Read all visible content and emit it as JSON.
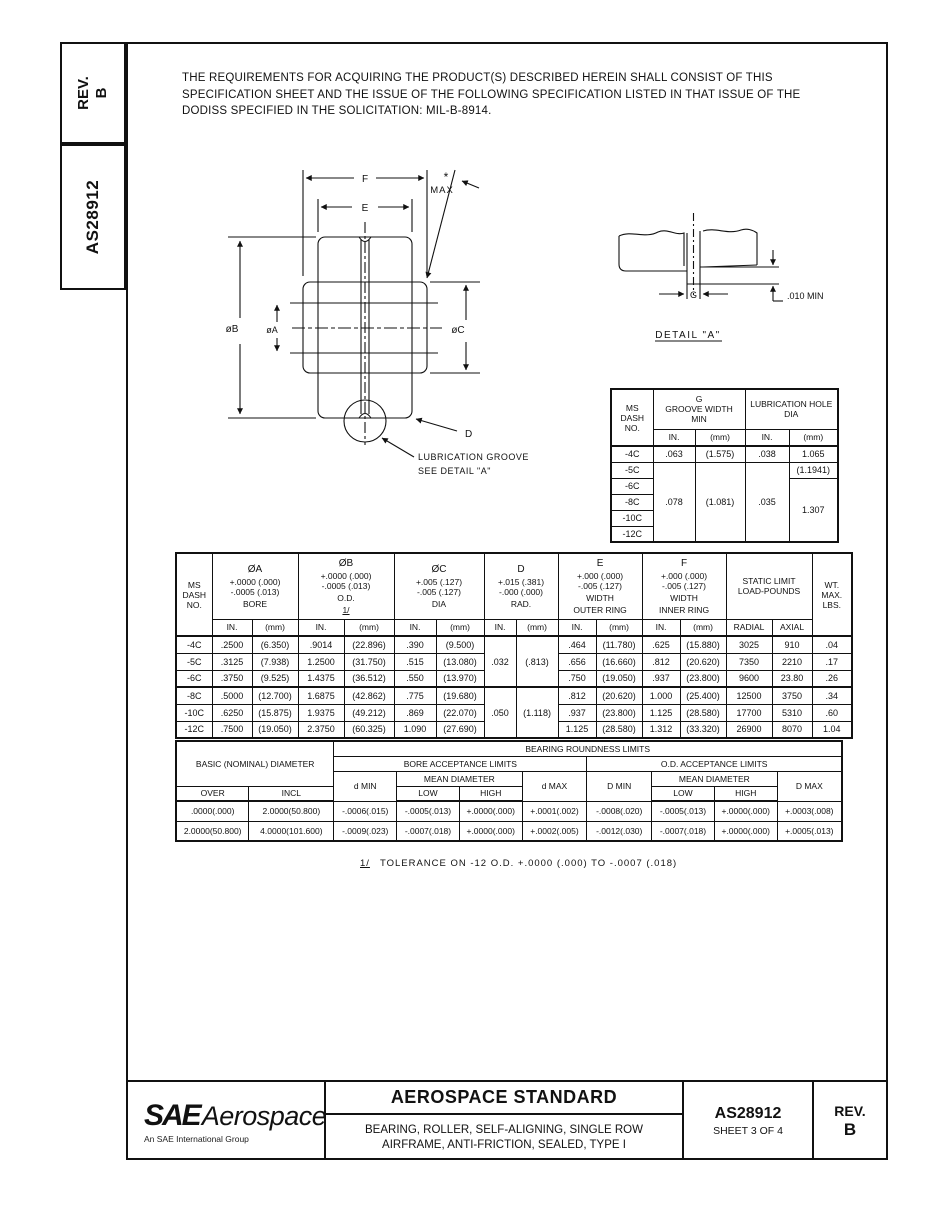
{
  "sidebar": {
    "rev": "REV.\nB",
    "doc_number": "AS28912"
  },
  "intro": {
    "text": "THE REQUIREMENTS FOR ACQUIRING THE PRODUCT(S) DESCRIBED HEREIN SHALL CONSIST OF THIS\nSPECIFICATION SHEET AND THE ISSUE OF THE FOLLOWING SPECIFICATION LISTED IN THAT ISSUE OF THE\nDODISS SPECIFIED IN THE SOLICITATION:  MIL-B-8914."
  },
  "drawing": {
    "f": "F",
    "e": "E",
    "asterisk": "*",
    "max": "MAX",
    "dia_b": "øB",
    "dia_a": "øA",
    "dia_c": "øC",
    "d": "D",
    "lube_line1": "LUBRICATION  GROOVE",
    "lube_line2": "SEE  DETAIL  \"A\"",
    "detail_g": "G",
    "detail_min": ".010 MIN",
    "detail_title": "DETAIL \"A\""
  },
  "groove_table": {
    "h_dash": "MS\nDASH\nNO.",
    "h_g": "G\nGROOVE WIDTH\nMIN",
    "h_hole": "LUBRICATION HOLE\nDIA",
    "h_in": "IN.",
    "h_mm": "(mm)",
    "dash": [
      "-4C",
      "-5C",
      "-6C",
      "-8C",
      "-10C",
      "-12C"
    ],
    "r4c": {
      "g_in": ".063",
      "g_mm": "(1.575)",
      "hole_in": ".038",
      "hole_mm": "1.065"
    },
    "r5c": {
      "hole_mm": "(1.1941)"
    },
    "merged": {
      "g_in": ".078",
      "g_mm": "(1.081)",
      "hole_in": ".035",
      "hole_mm": "1.307"
    }
  },
  "dim_table": {
    "h_dash": "MS\nDASH\nNO.",
    "h_in": "IN.",
    "h_mm": "(mm)",
    "cols": {
      "a": {
        "sym": "ØA",
        "tol1": "+.0000 (.000)",
        "tol2": "-.0005 (.013)",
        "name": "BORE"
      },
      "b": {
        "sym": "ØB",
        "tol1": "+.0000 (.000)",
        "tol2": "-.0005 (.013)",
        "name": "O.D.",
        "note": "1/"
      },
      "c": {
        "sym": "ØC",
        "tol1": "+.005 (.127)",
        "tol2": "-.005 (.127)",
        "name": "DIA"
      },
      "d": {
        "sym": "D",
        "tol1": "+.015 (.381)",
        "tol2": "-.000 (.000)",
        "name": "RAD."
      },
      "e": {
        "sym": "E",
        "tol1": "+.000 (.000)",
        "tol2": "-.005 (.127)",
        "name": "WIDTH",
        "name2": "OUTER RING"
      },
      "f": {
        "sym": "F",
        "tol1": "+.000 (.000)",
        "tol2": "-.005 (.127)",
        "name": "WIDTH",
        "name2": "INNER RING"
      },
      "static": {
        "label": "STATIC LIMIT\nLOAD-POUNDS",
        "radial": "RADIAL",
        "axial": "AXIAL"
      },
      "wt": {
        "label": "WT.\nMAX.\nLBS."
      }
    },
    "d_groups": [
      {
        "in": ".032",
        "mm": "(.813)"
      },
      {
        "in": ".050",
        "mm": "(1.118)"
      }
    ],
    "rows": [
      {
        "dash": "-4C",
        "a_in": ".2500",
        "a_mm": "(6.350)",
        "b_in": ".9014",
        "b_mm": "(22.896)",
        "c_in": ".390",
        "c_mm": "(9.500)",
        "e_in": ".464",
        "e_mm": "(11.780)",
        "f_in": ".625",
        "f_mm": "(15.880)",
        "radial": "3025",
        "axial": "910",
        "wt": ".04"
      },
      {
        "dash": "-5C",
        "a_in": ".3125",
        "a_mm": "(7.938)",
        "b_in": "1.2500",
        "b_mm": "(31.750)",
        "c_in": ".515",
        "c_mm": "(13.080)",
        "e_in": ".656",
        "e_mm": "(16.660)",
        "f_in": ".812",
        "f_mm": "(20.620)",
        "radial": "7350",
        "axial": "2210",
        "wt": ".17"
      },
      {
        "dash": "-6C",
        "a_in": ".3750",
        "a_mm": "(9.525)",
        "b_in": "1.4375",
        "b_mm": "(36.512)",
        "c_in": ".550",
        "c_mm": "(13.970)",
        "e_in": ".750",
        "e_mm": "(19.050)",
        "f_in": ".937",
        "f_mm": "(23.800)",
        "radial": "9600",
        "axial": "23.80",
        "wt": ".26"
      },
      {
        "dash": "-8C",
        "a_in": ".5000",
        "a_mm": "(12.700)",
        "b_in": "1.6875",
        "b_mm": "(42.862)",
        "c_in": ".775",
        "c_mm": "(19.680)",
        "e_in": ".812",
        "e_mm": "(20.620)",
        "f_in": "1.000",
        "f_mm": "(25.400)",
        "radial": "12500",
        "axial": "3750",
        "wt": ".34"
      },
      {
        "dash": "-10C",
        "a_in": ".6250",
        "a_mm": "(15.875)",
        "b_in": "1.9375",
        "b_mm": "(49.212)",
        "c_in": ".869",
        "c_mm": "(22.070)",
        "e_in": ".937",
        "e_mm": "(23.800)",
        "f_in": "1.125",
        "f_mm": "(28.580)",
        "radial": "17700",
        "axial": "5310",
        "wt": ".60"
      },
      {
        "dash": "-12C",
        "a_in": ".7500",
        "a_mm": "(19.050)",
        "b_in": "2.3750",
        "b_mm": "(60.325)",
        "c_in": "1.090",
        "c_mm": "(27.690)",
        "e_in": "1.125",
        "e_mm": "(28.580)",
        "f_in": "1.312",
        "f_mm": "(33.320)",
        "radial": "26900",
        "axial": "8070",
        "wt": "1.04"
      }
    ]
  },
  "roundness_table": {
    "h_basic": "BASIC (NOMINAL) DIAMETER",
    "h_title": "BEARING ROUNDNESS LIMITS",
    "h_bore": "BORE ACCEPTANCE LIMITS",
    "h_od": "O.D. ACCEPTANCE LIMITS",
    "h_mean": "MEAN DIAMETER",
    "h_over": "OVER",
    "h_incl": "INCL",
    "h_dmin": "d MIN",
    "h_dmax": "d MAX",
    "h_Dmin": "D MIN",
    "h_Dmax": "D MAX",
    "h_low": "LOW",
    "h_high": "HIGH",
    "rows": [
      {
        "over": ".0000(.000)",
        "incl": "2.0000(50.800)",
        "d_min": "-.0006(.015)",
        "low": "-.0005(.013)",
        "high": "+.0000(.000)",
        "d_max": "+.0001(.002)",
        "D_min": "-.0008(.020)",
        "D_low": "-.0005(.013)",
        "D_high": "+.0000(.000)",
        "D_max": "+.0003(.008)"
      },
      {
        "over": "2.0000(50.800)",
        "incl": "4.0000(101.600)",
        "d_min": "-.0009(.023)",
        "low": "-.0007(.018)",
        "high": "+.0000(.000)",
        "d_max": "+.0002(.005)",
        "D_min": "-.0012(.030)",
        "D_low": "-.0007(.018)",
        "D_high": "+.0000(.000)",
        "D_max": "+.0005(.013)"
      }
    ]
  },
  "footnote": {
    "ref": "1/",
    "text": "TOLERANCE ON -12 O.D. +.0000 (.000) TO -.0007 (.018)"
  },
  "footer": {
    "logo_sae": "SAE",
    "logo_aero": "Aerospace",
    "logo_tag": "An SAE International Group",
    "title": "AEROSPACE STANDARD",
    "sub1": "BEARING, ROLLER, SELF-ALIGNING, SINGLE ROW",
    "sub2": "AIRFRAME, ANTI-FRICTION, SEALED, TYPE I",
    "doc": "AS28912",
    "sheet": "SHEET 3 OF 4",
    "rev_label": "REV.",
    "rev_value": "B"
  }
}
